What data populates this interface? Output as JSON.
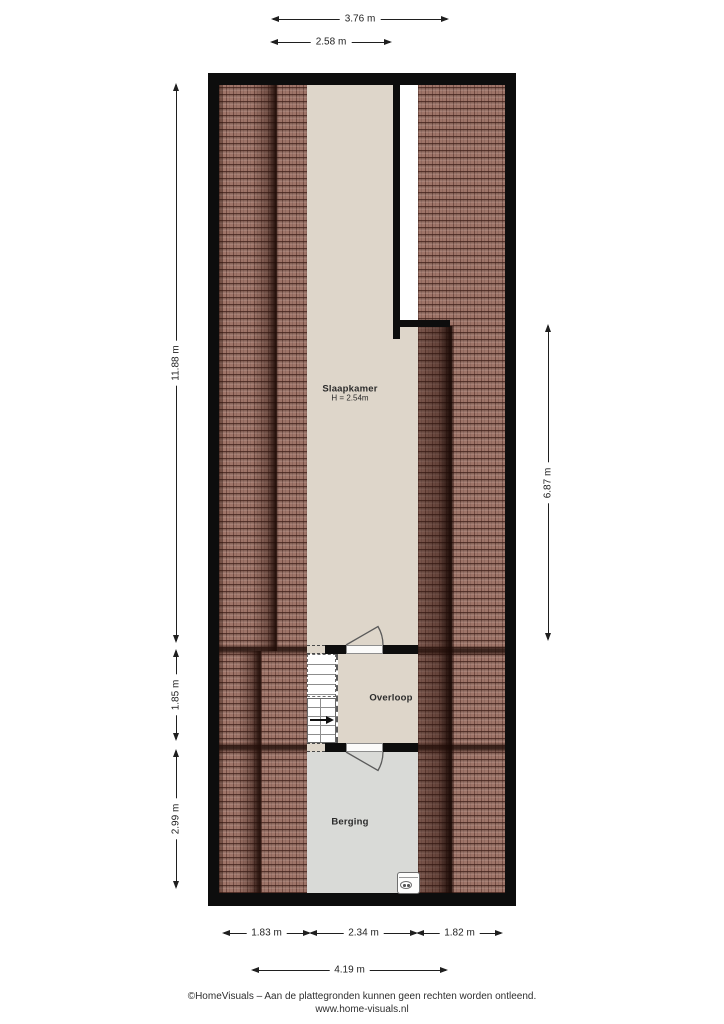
{
  "rooms": {
    "slaapkamer": {
      "name": "Slaapkamer",
      "height_note": "H = 2.54m"
    },
    "overloop": {
      "name": "Overloop"
    },
    "berging": {
      "name": "Berging"
    }
  },
  "dimensions": {
    "top": [
      {
        "label": "3.76 m"
      },
      {
        "label": "2.58 m"
      }
    ],
    "left": [
      {
        "label": "11.88 m"
      },
      {
        "label": "1.85 m"
      },
      {
        "label": "2.99 m"
      }
    ],
    "right": [
      {
        "label": "6.87 m"
      }
    ],
    "bottom": [
      {
        "label": "1.83 m"
      },
      {
        "label": "2.34 m"
      },
      {
        "label": "1.82 m"
      },
      {
        "label": "4.19 m"
      }
    ]
  },
  "footer": {
    "line1": "©HomeVisuals – Aan de plattegronden kunnen geen rechten worden ontleend.",
    "line2": "www.home-visuals.nl"
  },
  "icons": {
    "appliance": "washing-machine-top-view",
    "stair_direction": "arrow-right"
  },
  "colors": {
    "wall": "#0d0d0d",
    "roof_tile": "#9e7468",
    "roof_line": "#5a352c",
    "floor_beige": "#ded6ca",
    "floor_grey": "#d9dad7",
    "dimension_ink": "#1f1f1f"
  }
}
